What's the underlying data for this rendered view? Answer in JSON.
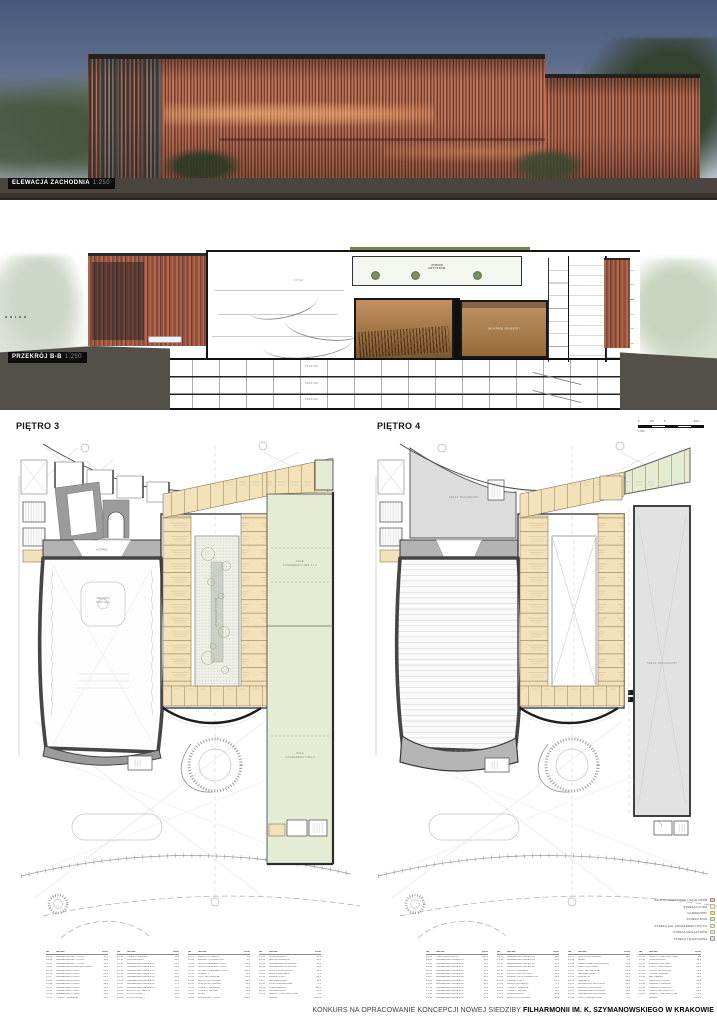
{
  "page": {
    "footer_regular": "KONKURS NA OPRACOWANIE KONCEPCJI NOWEJ SIEDZIBY",
    "footer_bold": "FILHARMONII IM. K. SZYMANOWSKIEGO W KRAKOWIE"
  },
  "elevation": {
    "label": "ELEWACJA ZACHODNIA",
    "scale": "1:250"
  },
  "section": {
    "label": "PRZEKRÓJ B-B",
    "scale": "1:250",
    "labels": {
      "atrium_1": "ATRIUM",
      "atrium_2": "ARTYSTÓW",
      "sala_prob": "SALA PRÓB ORKIESTRY",
      "parking": "PARKING",
      "foyer": "FOYER"
    }
  },
  "plans": [
    {
      "title": "PIĘTRO 3",
      "labels": {
        "hall_1": "WIDOWNIA",
        "hall_2": "DUŻA SALA",
        "stage": "ESTRADA",
        "atrium": "ATRIUM ARTYSTÓW",
        "conf_upper_1": "SALE",
        "conf_upper_2": "KONFERENCYJNE 1 I 2",
        "conf_lower_1": "SALA",
        "conf_lower_2": "KONFERENCYJNA 3"
      }
    },
    {
      "title": "PIĘTRO 4",
      "labels": {
        "taras_top": "TARAS TECHNICZNY",
        "taras_right": "TARAS TECHNICZNY",
        "balkon": "BALKON TECHNICZNY"
      }
    }
  ],
  "scalebar": {
    "t0": "0",
    "t1": "2,5",
    "t2": "5",
    "t3": "10 m",
    "scale": "1:250"
  },
  "legend": {
    "items": [
      {
        "label": "SALE KONCERTOWE I SALE PRÓB",
        "color": "#f0c9bd",
        "border": "#c37f72"
      },
      {
        "label": "STREFA FOYER",
        "color": "#f0f0e2",
        "border": "#b9b99e"
      },
      {
        "label": "GARDEROBY",
        "color": "#f3e1b6",
        "border": "#bfa668"
      },
      {
        "label": "STREFA BIUR",
        "color": "#dbe5c2",
        "border": "#9bb074"
      },
      {
        "label": "STREFA SAL KONFERENCYJNYCH",
        "color": "#e4ecd4",
        "border": "#a4b985"
      },
      {
        "label": "STREFA MAGAZYNÓW",
        "color": "#e7e7da",
        "border": "#b2b29c"
      },
      {
        "label": "STREFA TECHNICZNA",
        "color": "#dcdcdc",
        "border": "#9e9e9e"
      }
    ]
  },
  "tables": {
    "headers": [
      "NR",
      "NAZWA",
      "POW."
    ],
    "t3": {
      "groups": [
        [
          [
            "P3.01",
            "GARDEROBA ARTYSTÓW",
            "18,5"
          ],
          [
            "P3.02",
            "GARDEROBA ARTYSTÓW",
            "18,5"
          ],
          [
            "P3.03",
            "GARDEROBA ARTYSTÓW",
            "16,2"
          ],
          [
            "P3.04",
            "GARDEROBA ZBIOROWA CHÓRU",
            "42,6"
          ],
          [
            "P3.05",
            "GARDEROBA CHÓRU",
            "24,8"
          ],
          [
            "P3.06",
            "GARDEROBA CHÓRU",
            "24,8"
          ],
          [
            "P3.07",
            "GARDEROBA CHÓRU",
            "21,4"
          ],
          [
            "P3.08",
            "GARDEROBA CHÓRU",
            "21,4"
          ],
          [
            "P3.09",
            "GARDEROBA CHÓRU",
            "19,6"
          ],
          [
            "P3.10",
            "GARDEROBA CHÓRU",
            "19,6"
          ],
          [
            "P3.11",
            "GARDEROBA CHÓRU",
            "18,2"
          ],
          [
            "P3.12",
            "GARDEROBA CHÓRU",
            "18,2"
          ],
          [
            "P3.13",
            "TOALETY DAMSKIE",
            "12,4"
          ]
        ],
        [
          [
            "P3.14",
            "TOALETY MĘSKIE",
            "12,4"
          ],
          [
            "P3.15",
            "KOMUNIKACJA",
            "86,0"
          ],
          [
            "P3.16",
            "GARDEROBA ORKIESTRY",
            "22,6"
          ],
          [
            "P3.17",
            "GARDEROBA ORKIESTRY",
            "22,6"
          ],
          [
            "P3.18",
            "GARDEROBA ORKIESTRY",
            "20,4"
          ],
          [
            "P3.19",
            "GARDEROBA ORKIESTRY",
            "20,4"
          ],
          [
            "P3.20",
            "GARDEROBA ORKIESTRY",
            "18,8"
          ],
          [
            "P3.21",
            "GARDEROBA ORKIESTRY",
            "18,8"
          ],
          [
            "P3.22",
            "GARDEROBA ORKIESTRY",
            "17,5"
          ],
          [
            "P3.23",
            "GARDEROBA ORKIESTRY",
            "17,5"
          ],
          [
            "P3.24",
            "POKÓJ DYRYGENTA",
            "16,4"
          ],
          [
            "P3.25",
            "POKÓJ SOLISTY",
            "14,2"
          ],
          [
            "P3.26",
            "POKÓJ SOLISTY",
            "14,2"
          ]
        ],
        [
          [
            "P3.27",
            "ANEKS KUCHENNY",
            "8,6"
          ],
          [
            "P3.28",
            "MAGAZYN PODRĘCZNY",
            "9,2"
          ],
          [
            "P3.29",
            "SALA KONFERENCYJNA 1",
            "124,0"
          ],
          [
            "P3.30",
            "SALA KONFERENCYJNA 2",
            "86,5"
          ],
          [
            "P3.31",
            "FOYER KONFERENCYJNE",
            "210,0"
          ],
          [
            "P3.32",
            "MAGAZYN",
            "16,8"
          ],
          [
            "P3.33",
            "POM. TECHNICZNE",
            "24,0"
          ],
          [
            "P3.34",
            "KLATKA SCHODOWA",
            "18,6"
          ],
          [
            "P3.35",
            "KLATKA SCHODOWA",
            "18,6"
          ],
          [
            "P3.36",
            "TOALETY DAMSKIE",
            "14,2"
          ],
          [
            "P3.37",
            "TOALETY MĘSKIE",
            "14,2"
          ],
          [
            "P3.38",
            "WINDY",
            "8,4"
          ],
          [
            "P3.39",
            "ATRIUM ARTYSTÓW",
            "186,0"
          ]
        ],
        [
          [
            "P3.40",
            "KOMUNIKACJA",
            "64,2"
          ],
          [
            "P3.41",
            "BALKON WIDOWNI",
            "96,5"
          ],
          [
            "P3.42",
            "GARDEROBA GOŚCINNA",
            "14,8"
          ],
          [
            "P3.43",
            "GARDEROBA GOŚCINNA",
            "14,8"
          ],
          [
            "P3.44",
            "POKÓJ ODPOCZYNKU",
            "18,4"
          ],
          [
            "P3.45",
            "ANEKS SANITARNY",
            "6,8"
          ],
          [
            "P3.46",
            "MAGAZYN NUT",
            "22,0"
          ],
          [
            "P3.47",
            "SERWEROWNIA",
            "12,2"
          ],
          [
            "P3.48",
            "POM. PORZĄDKOWE",
            "6,4"
          ],
          [
            "P3.49",
            "TARAS ZIELONY",
            "148,0"
          ],
          [
            "P3.50",
            "KOMUNIKACJA",
            "38,6"
          ],
          [
            "P3.51",
            "SZACHTY INSTALACYJNE",
            "9,8"
          ],
          [
            "",
            "RAZEM",
            "1 842,6"
          ]
        ]
      ]
    },
    "t4": {
      "groups": [
        [
          [
            "P4.01",
            "TARAS TECHNICZNY",
            "385,0"
          ],
          [
            "P4.02",
            "GARDEROBA ORKIESTRY",
            "16,4"
          ],
          [
            "P4.03",
            "GARDEROBA ORKIESTRY",
            "16,4"
          ],
          [
            "P4.04",
            "GARDEROBA ORKIESTRY",
            "16,4"
          ],
          [
            "P4.05",
            "GARDEROBA ORKIESTRY",
            "16,4"
          ],
          [
            "P4.06",
            "GARDEROBA ORKIESTRY",
            "16,4"
          ],
          [
            "P4.07",
            "GARDEROBA ORKIESTRY",
            "16,4"
          ],
          [
            "P4.08",
            "GARDEROBA ORKIESTRY",
            "16,4"
          ],
          [
            "P4.09",
            "GARDEROBA ORKIESTRY",
            "16,4"
          ],
          [
            "P4.10",
            "GARDEROBA ORKIESTRY",
            "16,4"
          ],
          [
            "P4.11",
            "GARDEROBA ORKIESTRY",
            "15,2"
          ],
          [
            "P4.12",
            "GARDEROBA ORKIESTRY",
            "15,2"
          ],
          [
            "P4.13",
            "GARDEROBA ORKIESTRY",
            "15,2"
          ]
        ],
        [
          [
            "P4.14",
            "GARDEROBA ORKIESTRY",
            "15,2"
          ],
          [
            "P4.15",
            "GARDEROBA ORKIESTRY",
            "14,8"
          ],
          [
            "P4.16",
            "GARDEROBA ORKIESTRY",
            "14,8"
          ],
          [
            "P4.17",
            "GARDEROBA ORKIESTRY",
            "14,8"
          ],
          [
            "P4.18",
            "POKÓJ STROJENIA",
            "12,6"
          ],
          [
            "P4.19",
            "POKÓJ ODPOCZYNKU",
            "18,4"
          ],
          [
            "P4.20",
            "MAGAZYN INSTRUMENTÓW",
            "38,2"
          ],
          [
            "P4.21",
            "MAGAZYN NUT",
            "22,0"
          ],
          [
            "P4.22",
            "ANEKS KUCHENNY",
            "8,6"
          ],
          [
            "P4.23",
            "TOALETY DAMSKIE",
            "12,4"
          ],
          [
            "P4.24",
            "TOALETY MĘSKIE",
            "12,4"
          ],
          [
            "P4.25",
            "KOMUNIKACJA",
            "92,4"
          ],
          [
            "P4.26",
            "KLATKA SCHODOWA",
            "18,6"
          ]
        ],
        [
          [
            "P4.27",
            "KLATKA SCHODOWA",
            "18,6"
          ],
          [
            "P4.28",
            "WINDY",
            "8,4"
          ],
          [
            "P4.29",
            "PRZESTRZEŃ TECHNICZNA",
            "96,0"
          ],
          [
            "P4.30",
            "WENTYLATORNIA",
            "64,2"
          ],
          [
            "P4.31",
            "POM. TECHNICZNE",
            "28,4"
          ],
          [
            "P4.32",
            "SERWEROWNIA",
            "12,2"
          ],
          [
            "P4.33",
            "WARSZTAT",
            "24,6"
          ],
          [
            "P4.34",
            "MAGAZYN",
            "16,8"
          ],
          [
            "P4.35",
            "ANTRESOLA SALI PRÓB",
            "48,0"
          ],
          [
            "P4.36",
            "BALKON TECHNICZNY",
            "86,2"
          ],
          [
            "P4.37",
            "GARDEROBA GOŚCINNA",
            "14,8"
          ],
          [
            "P4.38",
            "GARDEROBA GOŚCINNA",
            "14,8"
          ],
          [
            "P4.39",
            "POM. PORZĄDKOWE",
            "6,4"
          ]
        ],
        [
          [
            "P4.40",
            "SZACHTY INSTALACYJNE",
            "9,8"
          ],
          [
            "P4.41",
            "KOMUNIKACJA",
            "46,2"
          ],
          [
            "P4.42",
            "MAGAZYN ESTRADY",
            "52,0"
          ],
          [
            "P4.43",
            "POKÓJ INSPICJENTA",
            "10,8"
          ],
          [
            "P4.44",
            "POKÓJ TECHNIKÓW",
            "16,2"
          ],
          [
            "P4.45",
            "STUDIO NAGRAŃ",
            "32,6"
          ],
          [
            "P4.46",
            "REŻYSERKA",
            "18,4"
          ],
          [
            "P4.47",
            "AMPLIFIKATORNIA",
            "14,6"
          ],
          [
            "P4.48",
            "MAGAZYN ŚWIATŁA",
            "21,2"
          ],
          [
            "P4.49",
            "MAGAZYN DŹWIĘKU",
            "21,2"
          ],
          [
            "P4.50",
            "TARAS TECHNICZNY 2",
            "64,0"
          ],
          [
            "P4.51",
            "SZACHTY INSTALACYJNE",
            "9,8"
          ],
          [
            "",
            "RAZEM",
            "1 654,8"
          ]
        ]
      ]
    }
  }
}
